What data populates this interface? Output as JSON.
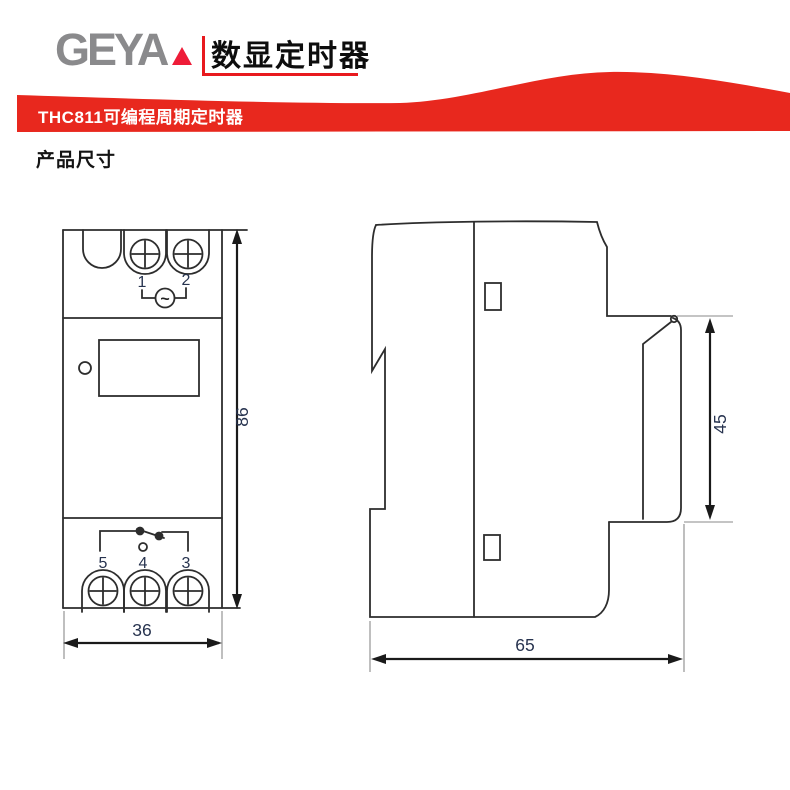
{
  "header": {
    "logo": "GEYA",
    "title": "数显定时器"
  },
  "banner": {
    "label": "THC811可编程周期定时器"
  },
  "section_heading": "产品尺寸",
  "front_view": {
    "terminal_top": [
      "1",
      "2"
    ],
    "ac_symbol": "~",
    "terminal_bottom": [
      "5",
      "4",
      "3"
    ],
    "dim_height": "86",
    "dim_width": "36"
  },
  "side_view": {
    "dim_clip": "45",
    "dim_depth": "65"
  },
  "colors": {
    "brand_red": "#e8281e",
    "logo_gray": "#8a8a8c",
    "line_color": "#2d2d2d",
    "dim_text_color": "#27334f"
  }
}
